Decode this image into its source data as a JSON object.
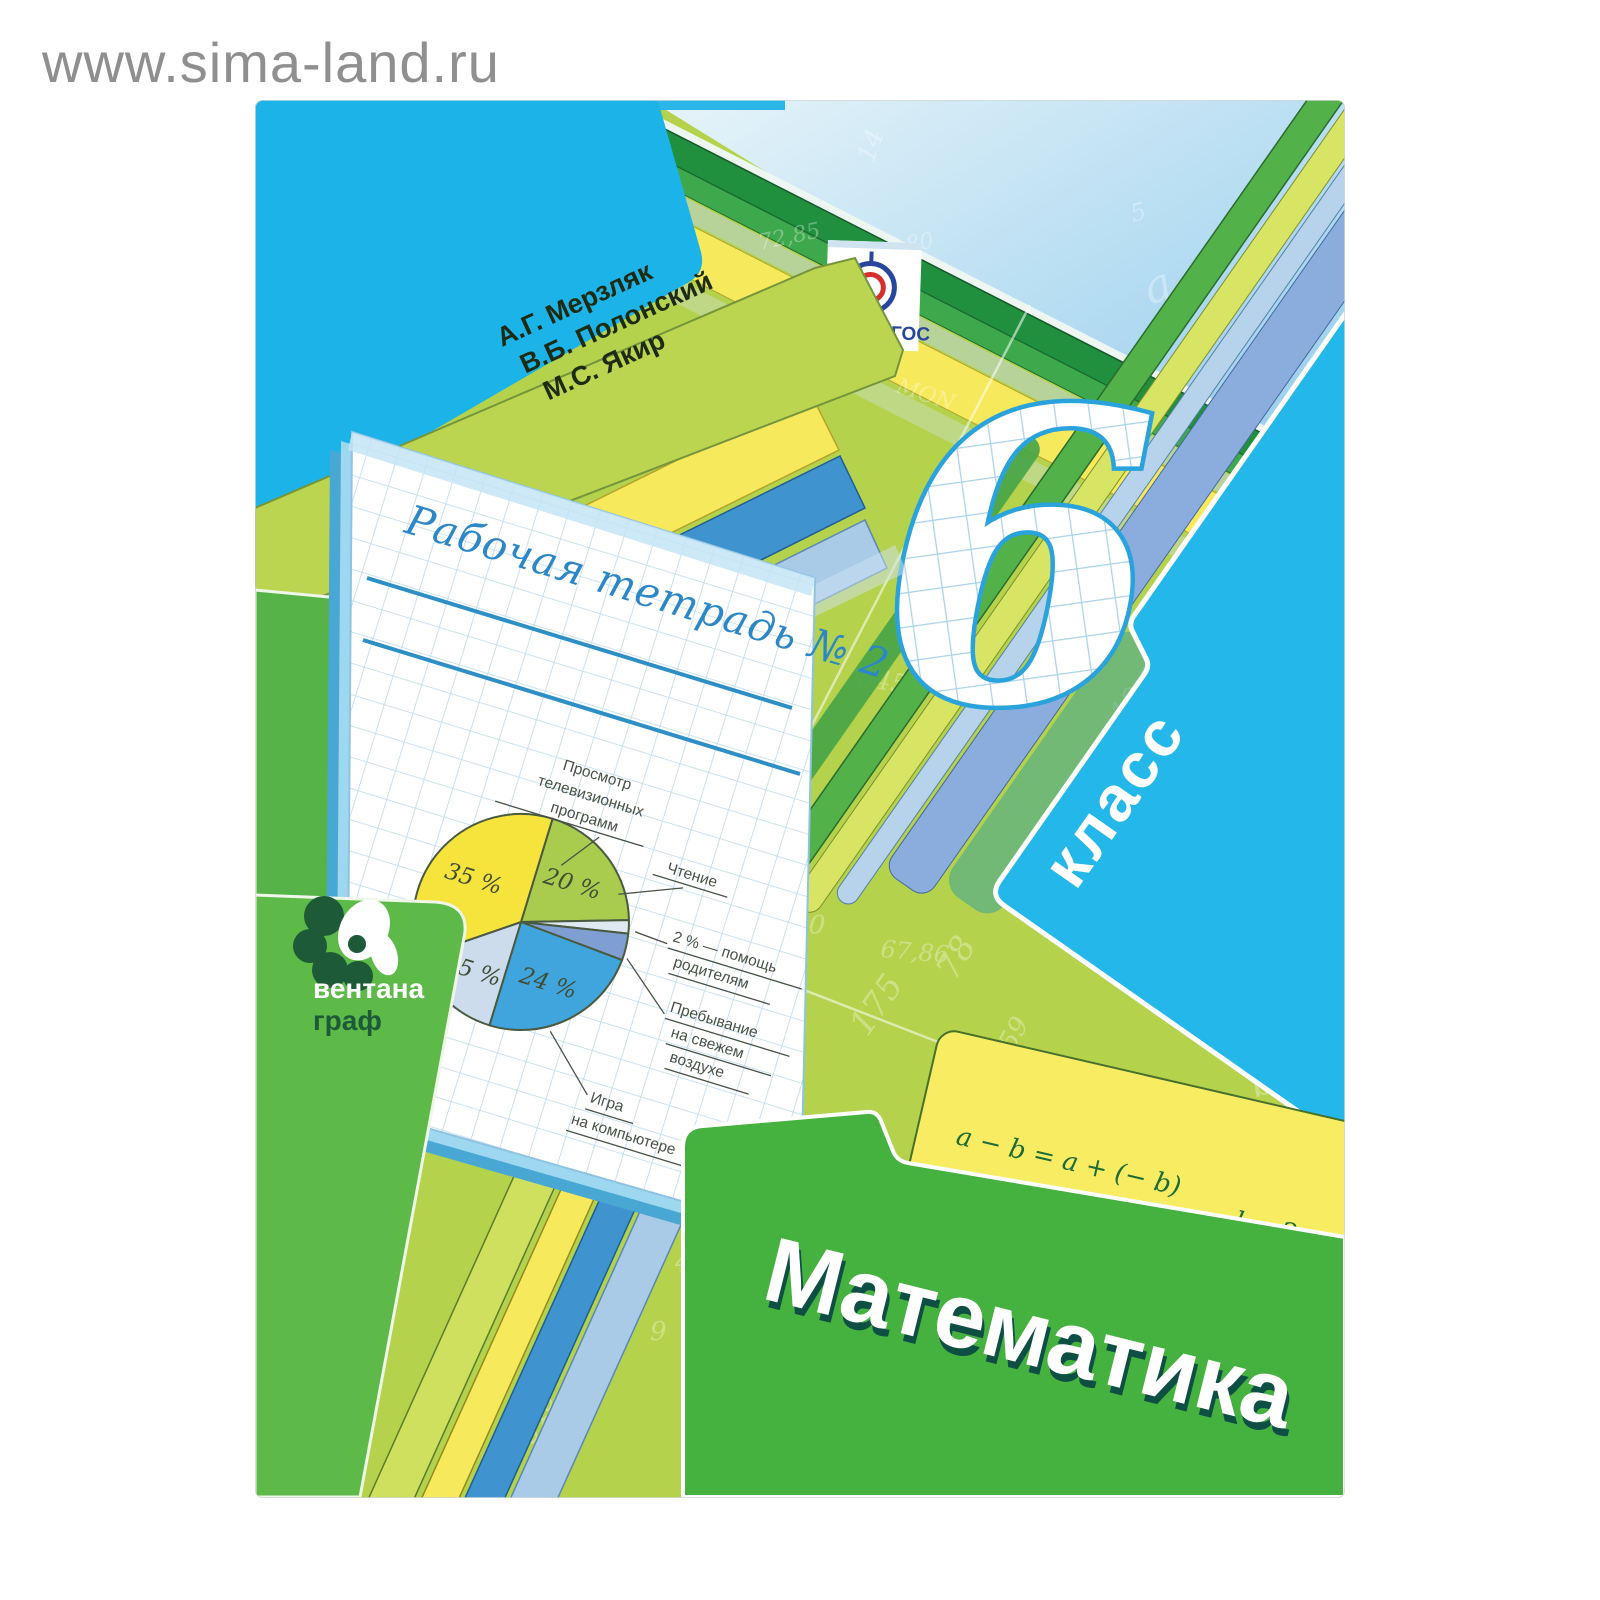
{
  "watermark": "www.sima-land.ru",
  "authors": {
    "line1": "А.Г. Мерзляк",
    "line2": "В.Б. Полонский",
    "line3": "М.С. Якир"
  },
  "fgos": {
    "label": "ФГОС"
  },
  "grade": {
    "number": "6",
    "word": "класс"
  },
  "workbook_title": "Рабочая тетрадь № 2",
  "subject_title": "Математика",
  "publisher": {
    "line1": "вентана",
    "line2": "граф"
  },
  "formulas": {
    "f1a": "a − b = a + (− b)",
    "f1b": "l = 2πr",
    "f2a": "−(−a) = a",
    "f2b": "d = 2r",
    "f3a": "a⁄b · c⁄d = a·c⁄b·d",
    "f3b": "|a| = |−a|",
    "f3c": "a⁄b = a·n⁄b·n",
    "f4": "a⁄b : c⁄d = a·d⁄b·c"
  },
  "pie": {
    "p35": "35 %",
    "p20": "20 %",
    "p15": "15 %",
    "p24": "24 %",
    "label_tv_1": "Просмотр",
    "label_tv_2": "телевизионных",
    "label_tv_3": "программ",
    "label_reading": "Чтение",
    "label_help_1": "2 % — помощь",
    "label_help_2": "родителям",
    "label_air_1": "Пребывание",
    "label_air_2": "на свежем",
    "label_air_3": "воздухе",
    "label_game_1": "Игра",
    "label_game_2": "на компьютере"
  },
  "chart_data": {
    "type": "pie",
    "slices": [
      {
        "label": "Просмотр телевизионных программ",
        "value": 35,
        "color": "#f6e43c"
      },
      {
        "label": "Чтение",
        "value": 20,
        "color": "#a9cc4e"
      },
      {
        "label": "помощь родителям",
        "value": 2,
        "color": "#dfe9f2"
      },
      {
        "label": "Пребывание на свежем воздухе",
        "value": 4,
        "color": "#7f9ed2"
      },
      {
        "label": "Игра на компьютере",
        "value": 24,
        "color": "#3fa5dc"
      },
      {
        "label": "",
        "value": 15,
        "color": "#ccdcec"
      }
    ],
    "legend_position": "callout-labels",
    "title": ""
  },
  "colors": {
    "field_green": "#b4d24c",
    "cyan_folder": "#1cb4e8",
    "subject_folder_green": "#45b13e",
    "yellow_band": "#f7e95c",
    "fgos_blue": "#27479e",
    "fgos_red": "#d6302e"
  },
  "doodles": {
    "d1": "231",
    "d2": "3,7",
    "d3": "72,85",
    "d4": "12,9",
    "d5": "545",
    "d6": "78",
    "d7": "150",
    "d8": "67,86",
    "d9": "175",
    "d10": "59",
    "d11": "MON",
    "d12": "4",
    "d13": "6,3",
    "d14": "∠ABC",
    "d15": "345",
    "d16": "3a + 5b",
    "d17": "a",
    "d18": "b",
    "d19": "189,3",
    "d20": "0,891",
    "d21": "m",
    "d22": "128",
    "d23": "80",
    "d24": "∠MON",
    "d25": "9",
    "d26": "C",
    "d27": "5",
    "d28": "14"
  }
}
